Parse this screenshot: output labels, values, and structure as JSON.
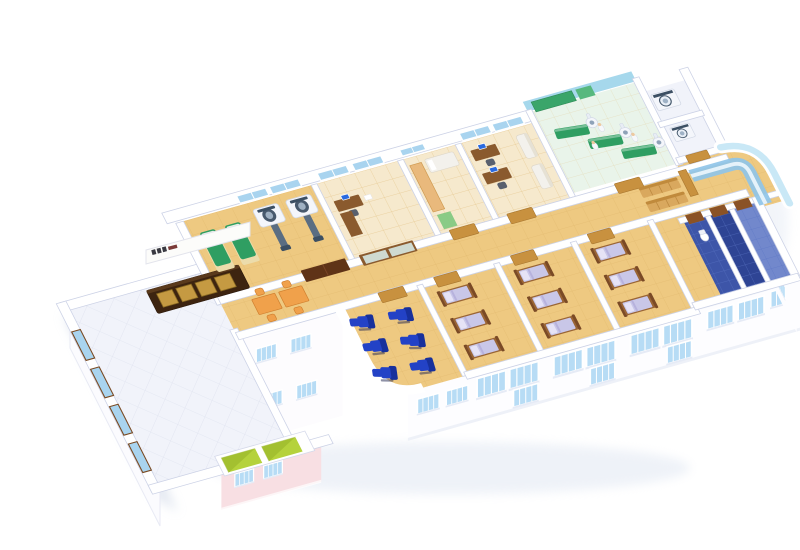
{
  "meta": {
    "title": "3D isometric cutaway floor plan rendering of a hospital clinic floor",
    "view": "aerial isometric cutaway, white background, no visible legible text (signboard logo illegible)"
  },
  "palette": {
    "wall_edge": "#ccd2e6",
    "floor_tan": "#eec981",
    "floor_tan_line": "#d8ae62",
    "floor_white": "#f1f3fa",
    "floor_white_line": "#dde1ee",
    "floor_cream": "#f6e9cd",
    "window_blue": "#a9d4ef",
    "facade_window": "#b7dcf5",
    "window_frame_brown": "#7a4a22",
    "glass_cyan": "#bfe4f4",
    "door_dark_brown": "#5f3317",
    "door_light_wood": "#c8913f",
    "desk_brown": "#8a5a2e",
    "reception_dark": "#3d2410",
    "reception_panel_amber": "#c59a42",
    "exam_green": "#2f9e62",
    "pt_wall_cyan": "#a6d8ec",
    "machine_white": "#f4f6fb",
    "machine_slate": "#3c4f63",
    "orange_furniture": "#f0a14b",
    "recliner_blue": "#2342c6",
    "recliner_blue_dark": "#17309c",
    "bed_frame_brown": "#7a4a26",
    "bed_linen_lavender": "#c9c7e8",
    "bed_pillow": "#e6e3f6",
    "bench_wood": "#d9a85e",
    "sofa_white": "#f3f1ec",
    "elevator_green": "#b5d23c",
    "bath_blue": "#3d55a8",
    "bath_blue_dark": "#2e4494",
    "bath_blue_light": "#7288cc",
    "facade_pink": "#f8dfe3",
    "desk_glass_blue": "#8fc4e8",
    "monitor_blue": "#2a6ae0"
  },
  "scene": {
    "building": "single hospital storey shown as cutaway; lower-storey facades with window rows visible below the floor plate",
    "rooms": [
      {
        "id": "lobby",
        "name": "Entrance lobby / reception",
        "floor": "white diamond tile",
        "items": [
          "dark-wood reception counter with 4 amber panels",
          "white signboard with small dark logo (illegible)",
          "4 brown-framed windows on left wall",
          "2 lime-green elevator cars"
        ]
      },
      {
        "id": "radiology",
        "name": "Radiology / CT room",
        "floor": "tan tile",
        "items": [
          "2 green exam couches",
          "2 CT scanner gantries with patient tables",
          "dark-brown double door",
          "2 back windows"
        ]
      },
      {
        "id": "consult-office",
        "name": "Consultation office",
        "floor": "cream tile",
        "items": [
          "L-shaped wooden desk",
          "computer monitor",
          "office chair",
          "wood-framed frosted-glass sliding door"
        ]
      },
      {
        "id": "treatment-room",
        "name": "Treatment / prep room",
        "floor": "cream tile",
        "items": [
          "tan storage counter",
          "white cot with pillow",
          "green floor mat",
          "light-wood door"
        ]
      },
      {
        "id": "staff-office",
        "name": "Staff office",
        "floor": "cream tile",
        "items": [
          "2 wooden desks with blue monitors",
          "2 white sofas",
          "2 back windows"
        ]
      },
      {
        "id": "physiotherapy",
        "name": "Physiotherapy / imaging hall with cyan walls",
        "floor": "pale green tile",
        "items": [
          "3 green treatment tables",
          "3 white mobile imaging machines",
          "green wall panels",
          "3 staff figures"
        ]
      },
      {
        "id": "equipment-rooms",
        "name": "Sterilizer / utility rooms",
        "floor": "white",
        "items": [
          "2 front-loading sterilizer units",
          "light-wood door"
        ]
      },
      {
        "id": "nurse-station",
        "name": "Rounded corner nurse station",
        "items": [
          "curved glass-blue counter",
          "curved cyan glass exterior wall"
        ]
      },
      {
        "id": "infusion-room",
        "name": "Infusion lounge with curved outer corner",
        "floor": "tan tile",
        "items": [
          "6 blue recliner chairs",
          "light-wood door"
        ]
      },
      {
        "id": "ward-1",
        "name": "Patient ward 1",
        "floor": "tan tile",
        "items": [
          "3 beds with brown frames, lavender linen, white pillows",
          "light-wood door"
        ]
      },
      {
        "id": "ward-2",
        "name": "Patient ward 2",
        "floor": "tan tile",
        "items": [
          "3 beds",
          "light-wood door"
        ]
      },
      {
        "id": "ward-3",
        "name": "Patient ward 3",
        "floor": "tan tile",
        "items": [
          "3 beds",
          "light-wood door"
        ]
      },
      {
        "id": "bathrooms",
        "name": "Washrooms with blue tiled floors",
        "items": [
          "3 blue-tiled stalls",
          "1 toilet",
          "3 brown doors"
        ]
      },
      {
        "id": "corridor",
        "name": "Central corridor",
        "floor": "tan tile",
        "items": [
          "2 orange tables",
          "4 orange stools",
          "2 wooden waiting benches"
        ]
      }
    ],
    "exterior": {
      "facades": [
        "front facade with rows of 4-pane light-blue windows (two storeys visible)",
        "pink-tinted wall section below the lobby with 2 windows",
        "right-end facade with 4 windows",
        "tall white wall with windows between lobby and infusion corner",
        "tall white wall below the left lobby edge"
      ]
    }
  }
}
